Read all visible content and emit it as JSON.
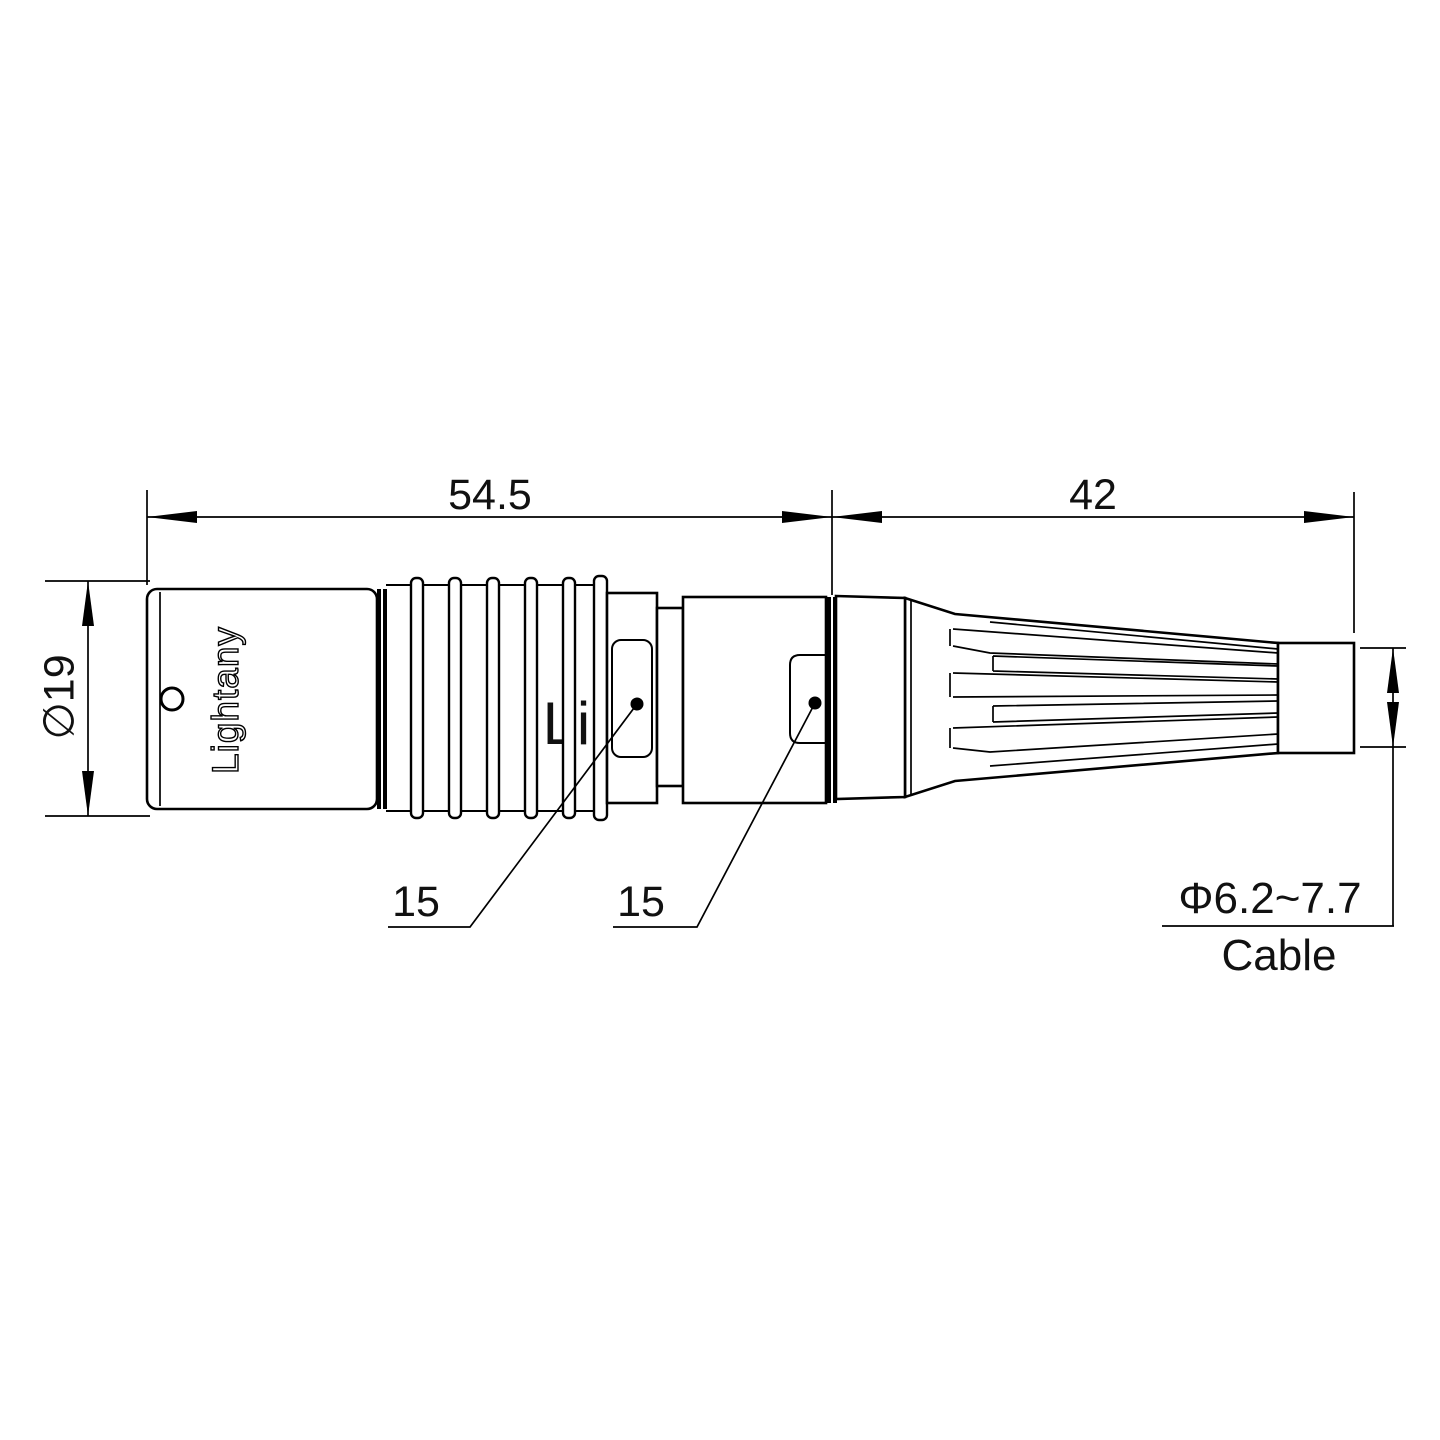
{
  "drawing": {
    "watermark": "Lightany",
    "shell_logo": "Lightany",
    "colors": {
      "line": "#000000",
      "watermark": "#f4c4c4"
    },
    "dimensions": {
      "overall_left": "54.5",
      "overall_right": "42",
      "diameter": "∅19",
      "leader_left": "15",
      "leader_right": "15",
      "cable_range": "Φ6.2~7.7",
      "cable_label": "Cable"
    }
  }
}
